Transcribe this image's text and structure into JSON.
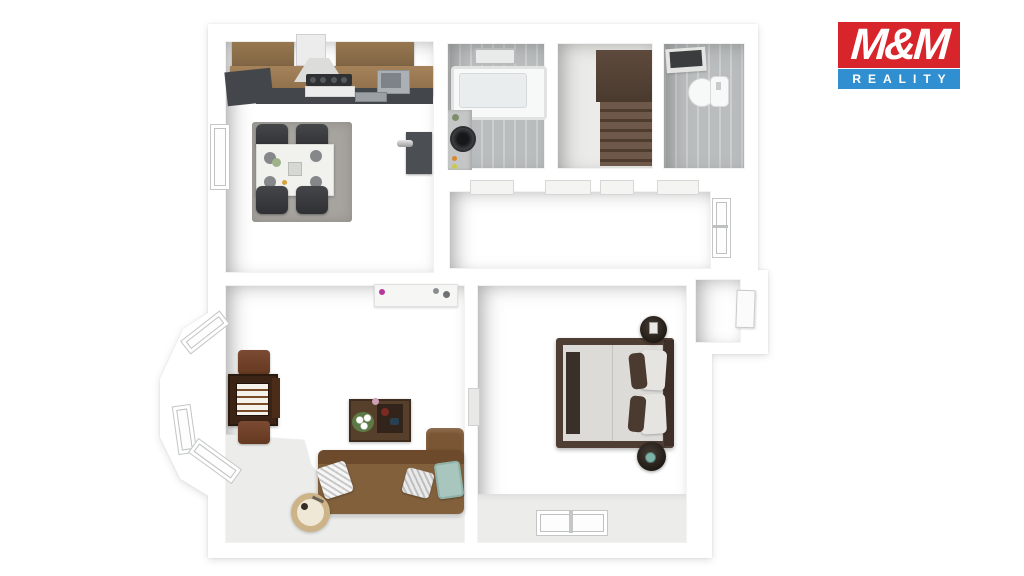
{
  "logo": {
    "title": "M&M",
    "subtitle": "REALITY"
  },
  "theme": {
    "logo-red": "#d8242b",
    "logo-blue": "#2f8fd0"
  },
  "scene": {
    "description": "3D top-down floor plan render of an apartment",
    "rooms": [
      "kitchen-dining",
      "bathroom",
      "staircase",
      "wc",
      "hallway",
      "living-room",
      "bedroom"
    ],
    "furniture": [
      "kitchen-cabinets",
      "range-hood",
      "stove",
      "kitchen-sink",
      "dining-table",
      "dining-chairs",
      "area-rug",
      "bathtub",
      "washing-machine",
      "towel-rack",
      "stairs",
      "toilet",
      "ceiling-vent",
      "sideboard",
      "bay-windows",
      "game-table",
      "side-chairs",
      "coffee-table",
      "corner-sofa",
      "floor-lamp",
      "throw-pillows",
      "double-bed",
      "nightstands",
      "windows",
      "doors"
    ]
  }
}
